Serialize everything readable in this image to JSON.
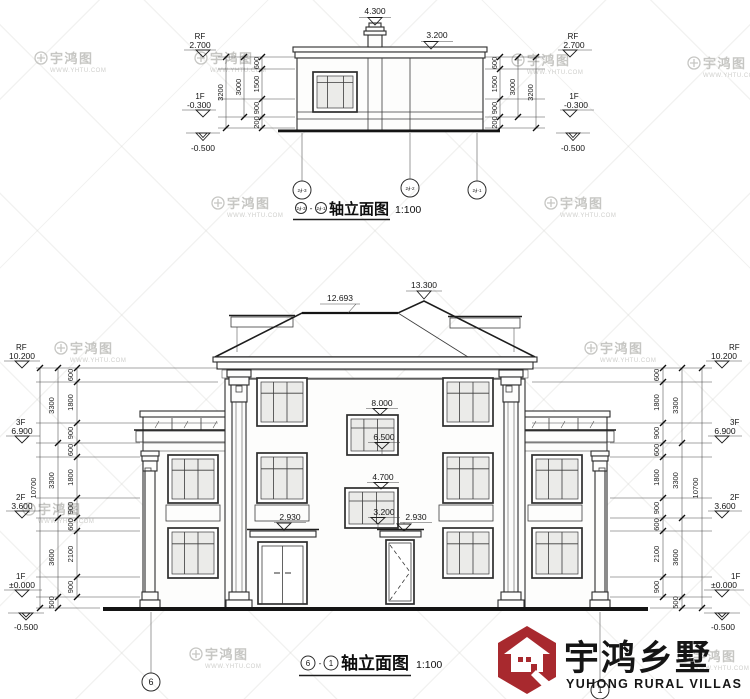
{
  "sheet": {
    "elevation_title": "轴立面图",
    "scale": "1:100",
    "title_separator": "-"
  },
  "watermark": {
    "name": "宇鸿图",
    "url": "WWW.YHTU.COM"
  },
  "top_drawing": {
    "labels": {
      "chimney_top": "4.300",
      "roof_level": "3.200"
    },
    "levels": [
      {
        "tag": "RF",
        "value": "2.700"
      },
      {
        "tag": "1F",
        "value": "-0.300"
      },
      {
        "tag": "",
        "value": "-0.500"
      }
    ],
    "dims": {
      "segments": [
        "600",
        "1500",
        "900",
        "200"
      ],
      "span": "3000",
      "total": "3200"
    },
    "axes": [
      "2∮-3",
      "2∮-2",
      "2∮-1"
    ]
  },
  "bottom_drawing": {
    "roof_labels": [
      "12.693",
      "13.300"
    ],
    "levels": [
      {
        "tag": "RF",
        "value": "10.200"
      },
      {
        "tag": "3F",
        "value": "6.900"
      },
      {
        "tag": "2F",
        "value": "3.600"
      },
      {
        "tag": "1F",
        "value": "±0.000"
      },
      {
        "tag": "",
        "value": "-0.500"
      }
    ],
    "dims": {
      "segments": [
        "600",
        "1800",
        "900",
        "600",
        "1800",
        "900",
        "600",
        "2100",
        "900"
      ],
      "spans": [
        "3300",
        "3300",
        "3600"
      ],
      "base": "500",
      "total": "10700"
    },
    "interior_levels": [
      "8.000",
      "6.500",
      "4.700",
      "3.200",
      "2.930",
      "2.930"
    ],
    "axes": [
      "6",
      "1"
    ]
  },
  "logo": {
    "name_cn": "宇鸿乡墅",
    "name_en": "YUHONG RURAL VILLAS",
    "brand_red": "#a8292e"
  }
}
